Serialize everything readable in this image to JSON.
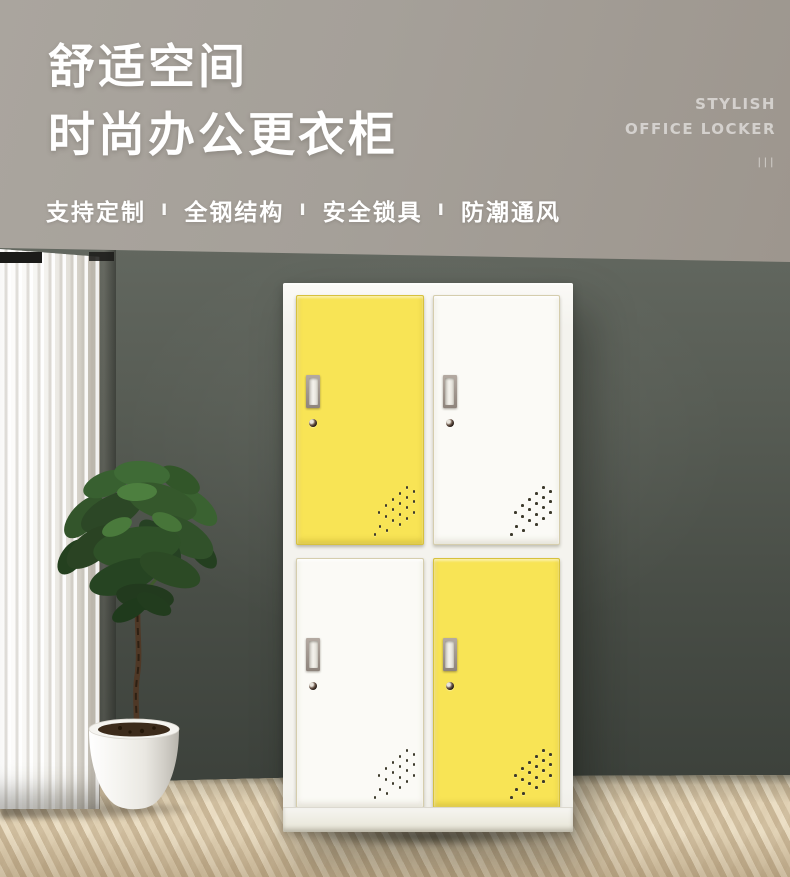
{
  "hero": {
    "title_line1": "舒适空间",
    "title_line2": "时尚办公更衣柜",
    "features": [
      "支持定制",
      "全钢结构",
      "安全锁具",
      "防潮通风"
    ],
    "separator": "I",
    "tagline_line1": "STYLISH",
    "tagline_line2": "OFFICE LOCKER",
    "tagline_bars": "|||"
  },
  "locker": {
    "pattern": [
      "yellow",
      "white",
      "white",
      "yellow"
    ],
    "door_colors": {
      "yellow": "#F8E455",
      "white": "#FBFAF6"
    }
  },
  "palette": {
    "ceiling": "#A29C94",
    "wall": "#4A4F49",
    "floor_wood": "#D3C1A2",
    "locker_body": "#F4F3EE",
    "accent_yellow": "#F8E455",
    "text_white": "#FFFFFF"
  }
}
